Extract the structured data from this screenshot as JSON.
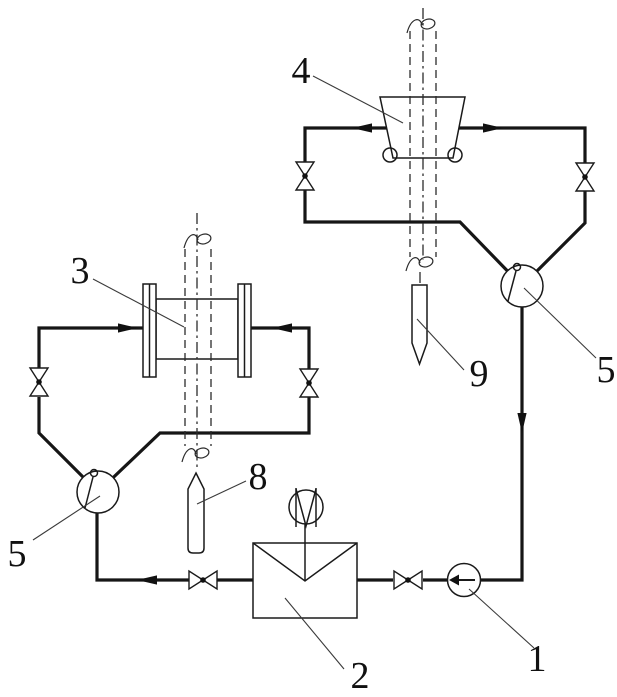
{
  "figure": {
    "background": "#ffffff",
    "ink": "#1a1a1a",
    "part_labels": {
      "part_1": "1",
      "part_2": "2",
      "part_3": "3",
      "part_4": "4",
      "part_5_left": "5",
      "part_5_right": "5",
      "part_8": "8",
      "part_9": "9"
    }
  }
}
